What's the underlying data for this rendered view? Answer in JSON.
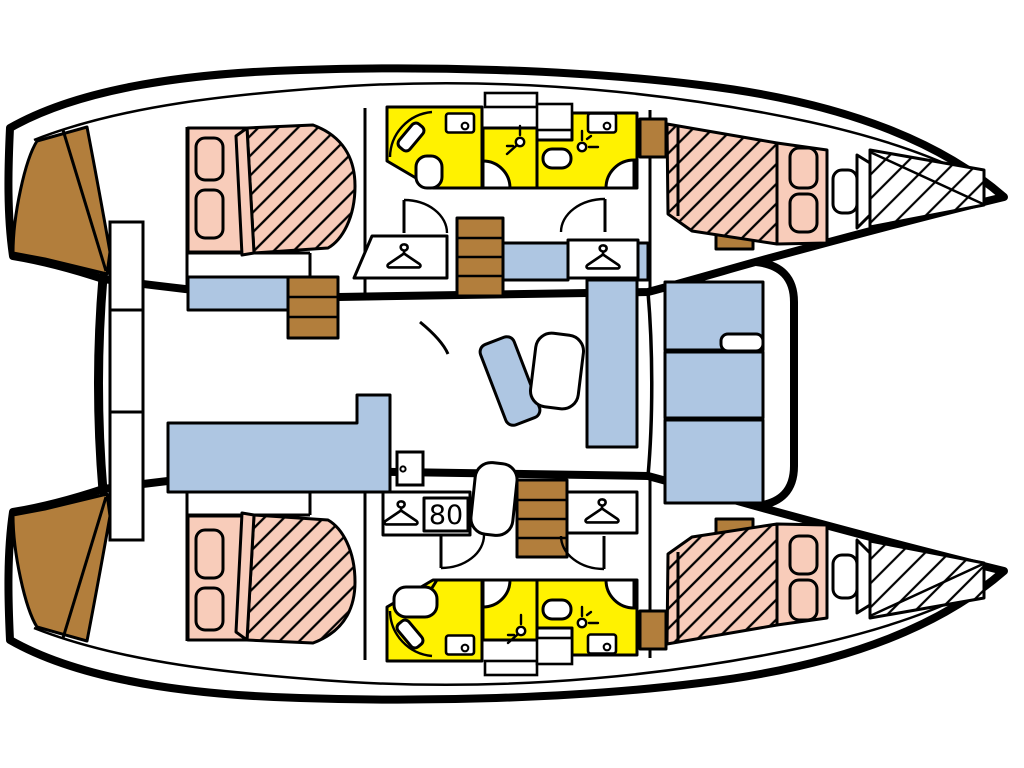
{
  "floorplan": {
    "wardrobe_width_label": "80"
  },
  "colors": {
    "outline": "#000000",
    "deck": "#ffffff",
    "bed": "#f8ccba",
    "wet_room": "#fff200",
    "seating": "#aec6e2",
    "wood": "#b27e3c"
  },
  "icons": {
    "hanger": "clothes-hanger-icon",
    "shower": "shower-head-icon",
    "sink": "sink-basin-icon",
    "toilet": "toilet-icon",
    "door_knob": "door-knob-icon",
    "door_swing": "door-swing-arc-icon"
  }
}
